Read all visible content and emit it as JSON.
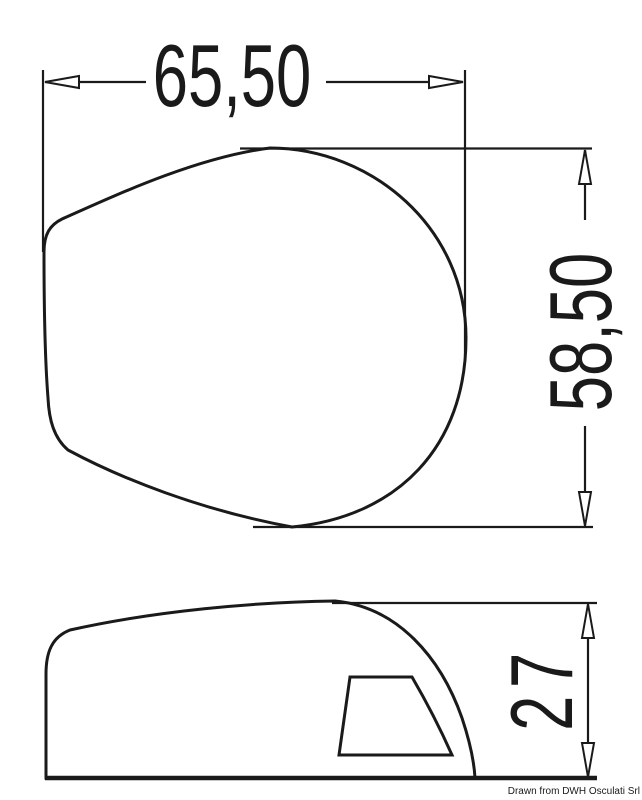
{
  "drawing": {
    "kind": "technical-dimension-drawing",
    "views": [
      "top-view",
      "side-view"
    ],
    "dimensions": {
      "width": {
        "label": "65,50"
      },
      "height": {
        "label": "58,50"
      },
      "depth": {
        "label": "27"
      }
    },
    "credit": "Drawn from DWH Osculati Srl",
    "colors": {
      "line": "#1a1a1a",
      "background": "#ffffff",
      "text": "#1a1a1a"
    }
  }
}
